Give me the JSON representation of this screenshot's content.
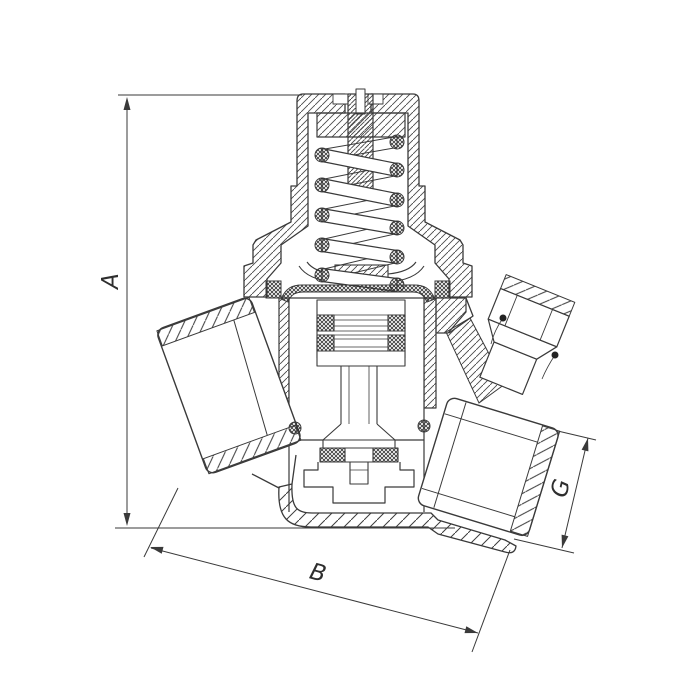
{
  "figure": {
    "kind": "technical-drawing",
    "subject": "pressure-reducing-valve-cross-section",
    "background_color": "#ffffff",
    "line_color": "#3a3a3a",
    "dimensions": {
      "a": {
        "label": "A",
        "orientation": "vertical-left",
        "measures": "overall-height"
      },
      "b": {
        "label": "B",
        "orientation": "diagonal-bottom",
        "measures": "overall-length"
      },
      "g": {
        "label": "G",
        "orientation": "diagonal-right",
        "measures": "outlet-port-size"
      }
    }
  }
}
